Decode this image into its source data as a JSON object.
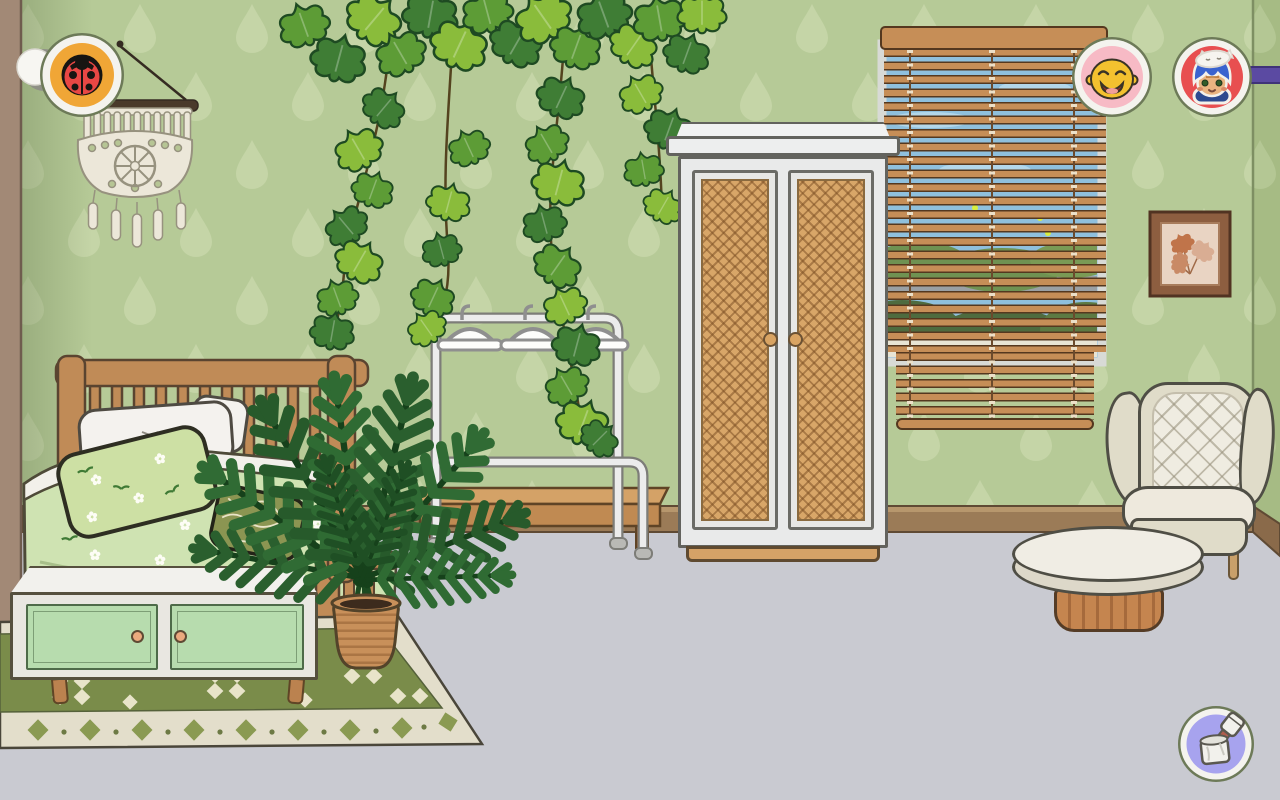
{
  "meta": {
    "scene_title": "pastel green bedroom",
    "style": "toca-world cartoon",
    "canvas": {
      "w": 1280,
      "h": 800
    }
  },
  "palette": {
    "wallpaper_base": "#b6ca97",
    "wallpaper_drop": "#c9d8ab",
    "left_wall": "#a28976",
    "right_wall_sliver": "#a6bb84",
    "baseboard": "#9b7b57",
    "floor": "#c9cad1",
    "wood": "#c08b57",
    "wood_dark": "#5a4430",
    "mint_door": "#b7dcae",
    "cream_fabric": "#e0dcc9",
    "duvet_green": "#cfe3b2",
    "rug_green": "#7a8c4a",
    "rug_cream": "#e3decb",
    "blind_slat": "#c68e57",
    "sky": "#8fc0dd",
    "rattan": "#d8a668",
    "hud_amber": "#f0a636",
    "hud_pink": "#f7bac5",
    "hud_red": "#e84f50",
    "hud_lavender": "#a7a3ee",
    "hud_rod_purple": "#5b4aa2"
  },
  "hud": {
    "side_handle": {
      "name": "side-menu-handle",
      "label": "side menu handle"
    },
    "ladybug_button": {
      "icon": "ladybug-icon",
      "label": "ladybug button",
      "ring_color": "#f0a636"
    },
    "character_buttons": [
      {
        "icon": "smiling-yellow-face-icon",
        "label": "character: smiling yellow face",
        "bg": "#f7bac5"
      },
      {
        "icon": "blue-hair-cat-hat-kid-icon",
        "label": "character: blue-haired kid with cat hat",
        "bg": "#e84f50"
      }
    ],
    "paint_button": {
      "icon": "paint-can-brush-icon",
      "label": "paint / decorate button",
      "bg": "#a7a3ee"
    },
    "purple_rod": {
      "name": "purple-rod",
      "label": "purple rod at screen edge"
    }
  },
  "scene": {
    "wall_decor": [
      {
        "name": "macrame-hanging",
        "label": "white macrame wall hanging on hook"
      },
      {
        "name": "pressed-leaves-picture",
        "label": "framed pressed autumn leaves"
      },
      {
        "name": "hanging-ivy",
        "label": "ivy vines hanging from ceiling"
      }
    ],
    "window": {
      "name": "window-with-blinds",
      "label": "window with wooden venetian blinds",
      "view": "blue sky and green bushes"
    },
    "furniture": [
      {
        "name": "bed",
        "label": "wooden bed with green floral bedding, white pillows, olive accent pillow"
      },
      {
        "name": "clothes-rack",
        "label": "white clothes rack with three hangers"
      },
      {
        "name": "bench",
        "label": "low wooden bench"
      },
      {
        "name": "wardrobe",
        "label": "white wardrobe with rattan doors"
      },
      {
        "name": "sideboard",
        "label": "mint two-door sideboard with peach knobs"
      },
      {
        "name": "palm-plant",
        "label": "potted palm in woven basket"
      },
      {
        "name": "rug",
        "label": "green rug with diamond pattern border"
      },
      {
        "name": "armchair",
        "label": "cream quilted wingback armchair"
      },
      {
        "name": "coffee-table",
        "label": "round coffee table with fluted wooden base"
      }
    ]
  }
}
